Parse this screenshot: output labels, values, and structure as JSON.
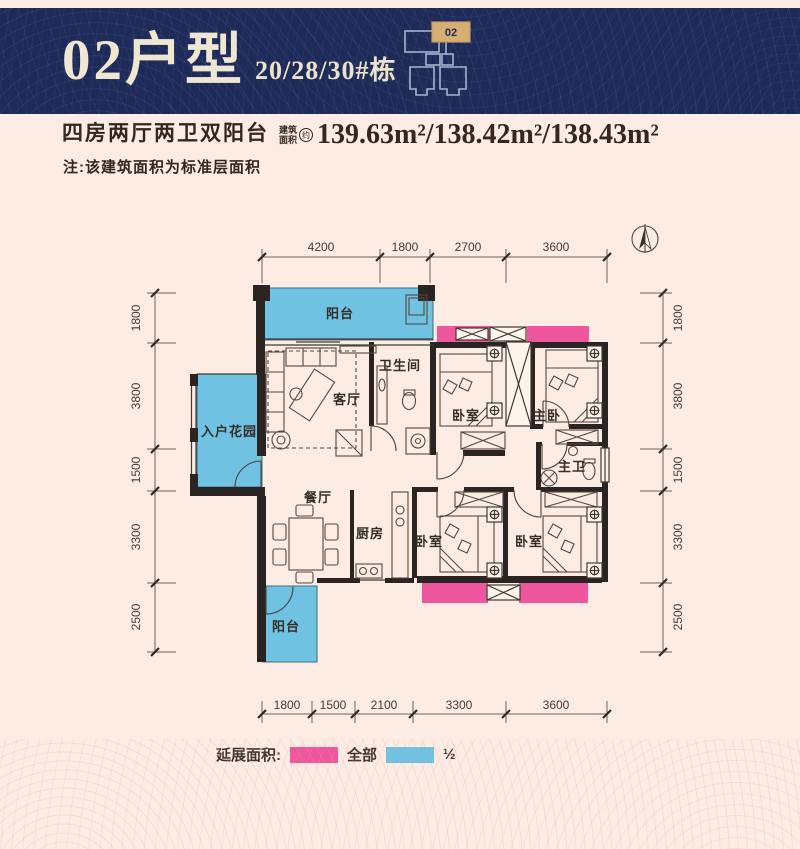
{
  "banner": {
    "title": "02户型",
    "subtitle": "20/28/30#栋",
    "locator_unit": "02"
  },
  "info": {
    "layout_title": "四房两厅两卫双阳台",
    "area_prefix_line1": "建筑",
    "area_prefix_line2": "面积",
    "area_prefix_circle": "约",
    "areas": "139.63m²/138.42m²/138.43m²",
    "note": "注:该建筑面积为标准层面积"
  },
  "plan": {
    "rooms": {
      "balcony_top": "阳台",
      "living": "客厅",
      "bath": "卫生间",
      "bedroom_top": "卧室",
      "master_bedroom": "主卧",
      "master_bath": "主卫",
      "entry_garden": "入户花园",
      "dining": "餐厅",
      "kitchen": "厨房",
      "bedroom_mid": "卧室",
      "bedroom_right": "卧室",
      "balcony_bottom": "阳台"
    },
    "dims": {
      "top": [
        "4200",
        "1800",
        "2700",
        "3600"
      ],
      "bottom": [
        "1800",
        "1500",
        "2100",
        "3300",
        "3600"
      ],
      "left": [
        "1800",
        "3800",
        "1500",
        "3300",
        "2500"
      ],
      "right": [
        "1800",
        "3800",
        "1500",
        "3300",
        "2500"
      ]
    }
  },
  "legend": {
    "label": "延展面积:",
    "full_label": "全部",
    "half_label": "½"
  },
  "colors": {
    "banner_navy": "#1e2a57",
    "accent_tan": "#d7ae74",
    "extend_pink": "#ee579d",
    "extend_blue": "#6fc2e2",
    "page_bg": "#fcece3",
    "wall": "#2a2522"
  }
}
